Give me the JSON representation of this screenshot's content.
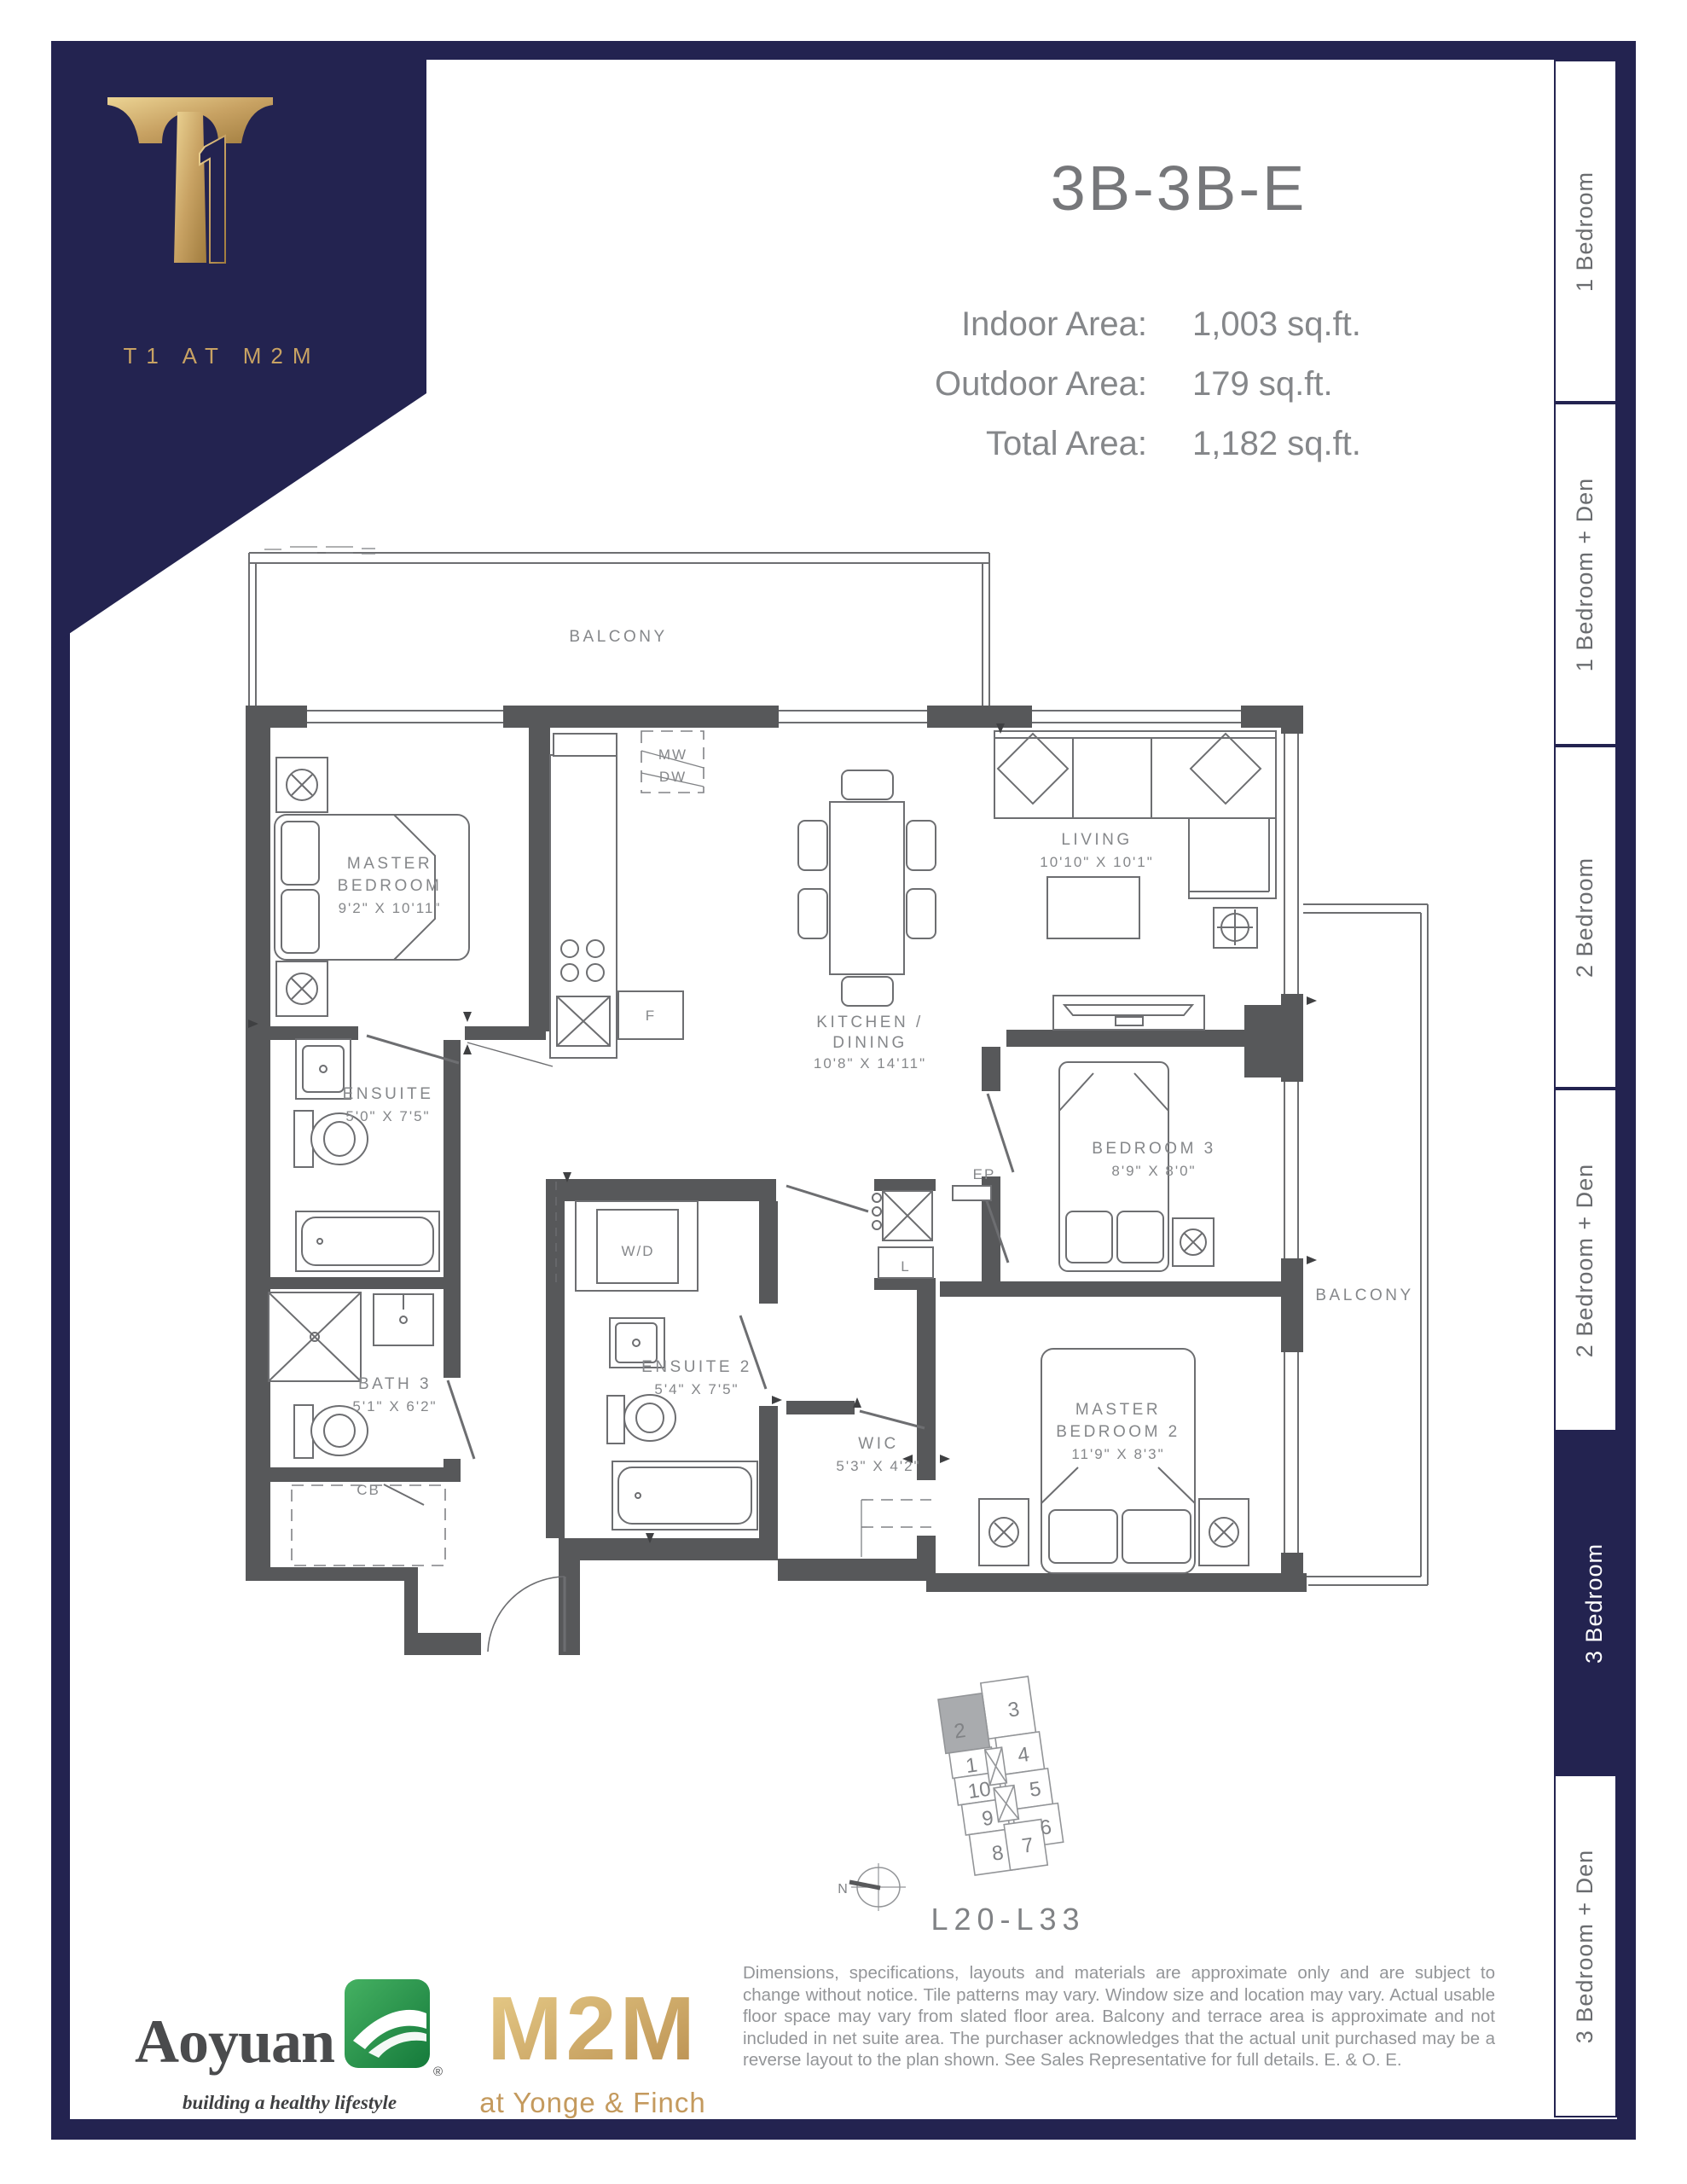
{
  "header": {
    "unit_name": "3B-3B-E",
    "areas": [
      {
        "label": "Indoor Area:",
        "value": "1,003 sq.ft."
      },
      {
        "label": "Outdoor Area:",
        "value": "179 sq.ft."
      },
      {
        "label": "Total Area:",
        "value": "1,182 sq.ft."
      }
    ]
  },
  "brand": {
    "caption": "T1 AT M2M"
  },
  "sidebar": {
    "tabs": [
      {
        "label": "1 Bedroom",
        "active": false
      },
      {
        "label": "1 Bedroom + Den",
        "active": false
      },
      {
        "label": "2 Bedroom",
        "active": false
      },
      {
        "label": "2 Bedroom + Den",
        "active": false
      },
      {
        "label": "3 Bedroom",
        "active": true
      },
      {
        "label": "3 Bedroom + Den",
        "active": false
      }
    ]
  },
  "plan": {
    "balcony_top": "BALCONY",
    "balcony_right": "BALCONY",
    "master_bedroom": {
      "l1": "MASTER",
      "l2": "BEDROOM",
      "dims": "9'2\" X 10'11\""
    },
    "ensuite": {
      "l1": "ENSUITE",
      "dims": "5'0\" X 7'5\""
    },
    "bath3": {
      "l1": "BATH 3",
      "dims": "5'1\" X 6'2\""
    },
    "kitchen": {
      "l1": "KITCHEN /",
      "l2": "DINING",
      "dims": "10'8\" X 14'11\""
    },
    "living": {
      "l1": "LIVING",
      "dims": "10'10\" X 10'1\""
    },
    "bedroom3": {
      "l1": "BEDROOM 3",
      "dims": "8'9\" X 8'0\""
    },
    "master_bedroom2": {
      "l1": "MASTER",
      "l2": "BEDROOM 2",
      "dims": "11'9\" X 8'3\""
    },
    "ensuite2": {
      "l1": "ENSUITE 2",
      "dims": "5'4\" X 7'5\""
    },
    "wic": {
      "l1": "WIC",
      "dims": "5'3\" X 4'2\""
    },
    "wd": "W/D",
    "cb": "CB",
    "linen": "L",
    "ep": "EP",
    "fridge": "F",
    "mw": "MW",
    "dw": "DW"
  },
  "keyplate": {
    "levels": "L20-L33",
    "north": "N",
    "units": [
      "1",
      "2",
      "3",
      "4",
      "5",
      "6",
      "7",
      "8",
      "9",
      "10"
    ],
    "highlighted_unit": "2"
  },
  "footer": {
    "disclaimer": "Dimensions, specifications, layouts and materials are approximate only and are subject to change without notice. Tile patterns may vary. Window size and location may vary. Actual usable floor space may vary from slated floor area. Balcony and terrace area is approximate and not included in net suite area. The purchaser acknowledges that the actual unit purchased may be a reverse layout to the plan shown. See Sales Representative for full details. E. & O. E.",
    "aoyuan": {
      "name": "Aoyuan",
      "tagline": "building a healthy lifestyle",
      "registered": "®"
    },
    "m2m": {
      "name": "M2M",
      "tagline": "at Yonge & Finch"
    }
  },
  "colors": {
    "navy": "#232350",
    "gold": "#c8a263",
    "heading_gray": "#76777a",
    "wall_gray": "#57585a",
    "line_gray": "#6d6e71",
    "text_gray": "#939598",
    "green": "#2aa14e",
    "keyplate_highlight": "#a9abae"
  }
}
